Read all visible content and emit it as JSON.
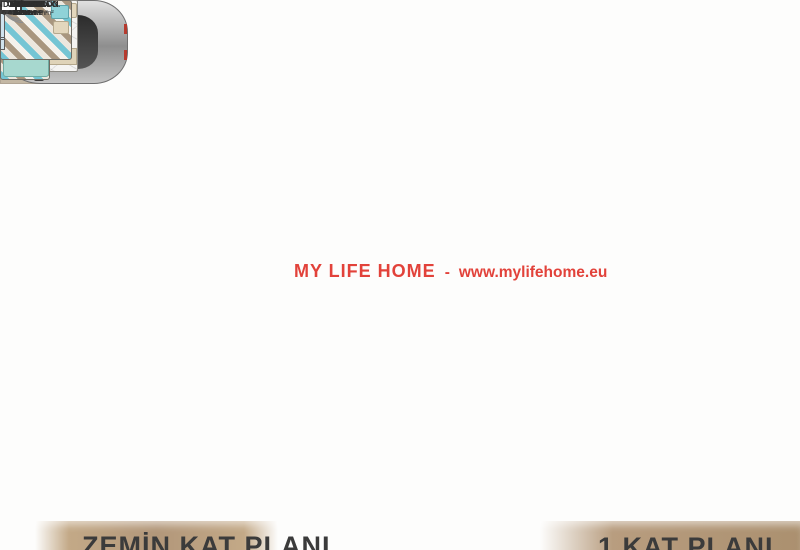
{
  "colors": {
    "watermark_red": "#e2423a",
    "caption_band": "#b0957a",
    "caption_text": "#3b3b3b",
    "wall": "#4a4a4a",
    "accent_teal": "#74c5d4",
    "stair_beige": "#f0e5c9"
  },
  "watermark": {
    "brand": "MY LIFE HOME",
    "separator": "-",
    "url": "www.mylifehome.eu"
  },
  "captions": {
    "left": "ZEMİN KAT PLANI",
    "right": "1.KAT PLANI"
  },
  "ground_floor": {
    "rooms": {
      "salon": {
        "name": "SALON",
        "area": "34.4 m²"
      },
      "small_room": {
        "area": "5.6 m²"
      },
      "garaj": {
        "name": "GARAJ",
        "area": "20.9 m²"
      },
      "banyo": {
        "name": "BANYO",
        "area": "3.8 m²"
      },
      "hol": {
        "name": "HOL",
        "area": "12.2 m²"
      },
      "hol2": {
        "name": "HOL",
        "area": "3.3 m²"
      },
      "veranda_right": {
        "name": "VERANDA",
        "area": "15.5 m²"
      },
      "mutfak": {
        "name": "MUTFAK",
        "area": "11.4 m²"
      },
      "kiler": {
        "name": "KİLER",
        "area": "3.0 m²"
      },
      "oda": {
        "name": "ODA",
        "area": "9.3 m²"
      },
      "veranda_left": {
        "name": "VERANDA",
        "area": "6 m²"
      }
    }
  },
  "first_floor": {
    "rooms": {
      "balkon": {
        "name": "BALKON",
        "area": "31.9 m²"
      },
      "ebeveyn": {
        "name": "EBEVEYN O.",
        "area": "17.6 m²"
      },
      "giyinme": {
        "name": "GİYİNME",
        "area": "4m²"
      },
      "wc": {
        "name": "WC",
        "area": "4.2 m²"
      },
      "banyo": {
        "name": "BANYO",
        "area": "7.6 m²"
      },
      "hol": {
        "area": "9.3 m²"
      },
      "oda1": {
        "name": "ODA",
        "area": "12.8 m²"
      },
      "terrace1": {
        "area": "4.1 m²"
      },
      "terrace2": {
        "area": "3.1 m²"
      },
      "oda2": {
        "name": "ODA",
        "area": "11.2 m²"
      }
    }
  }
}
